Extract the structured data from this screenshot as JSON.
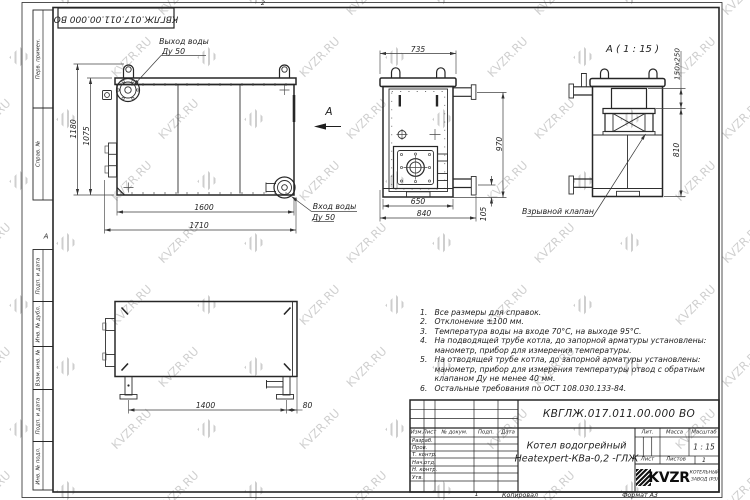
{
  "designations": {
    "main": "КВГЛЖ.017.011.00.000 ВО",
    "top_reversed": "КВГЛЖ.017.011.00.000 ВО"
  },
  "title_block": {
    "product_line1": "Котел водогрейный",
    "product_line2": "Heatexpert-КВа-0,2 -ГЛЖ",
    "cols": {
      "izm": "Изм.",
      "list": "Лист",
      "doc": "№ докум.",
      "podp": "Подп.",
      "data": "Дата"
    },
    "rows": {
      "r1": "Разраб.",
      "r2": "Пров.",
      "r3": "Т. контр.",
      "r4": "Нач.отд.",
      "r5": "Н. контр.",
      "r6": "Утв."
    },
    "lit": "Лит.",
    "massa": "Масса",
    "masshtab": "Масштаб",
    "scale": "1 : 15",
    "list_lbl": "Лист",
    "listov_lbl": "Листов",
    "listov_val": "1",
    "logo": "KVZR",
    "logo_sub1": "КОТЕЛЬНЫЙ",
    "logo_sub2": "ЗАВОД (РЗ)",
    "kopiroval": "Копировал",
    "format": "Формат А3"
  },
  "margins": {
    "perv": "Перв. примен.",
    "sprav": "Справ. №",
    "podp1": "Подп. и дата",
    "inv_dubl": "Инв. № дубл.",
    "vzam": "Взам. инв. №",
    "podp2": "Подп. и дата",
    "inv_podl": "Инв. № подл.",
    "zone_top": "2",
    "zone_left": "А",
    "zone_bottom": "1"
  },
  "callouts": {
    "outlet1": "Выход воды",
    "outlet2": "Ду 50",
    "inlet1": "Вход воды",
    "inlet2": "Ду 50",
    "view_arrow": "А",
    "detail_title": "А ( 1 : 15 )",
    "explosion": "Взрывной клапан"
  },
  "dims": {
    "d1180": "1180",
    "d1075": "1075",
    "d1600": "1600",
    "d1710": "1710",
    "d735": "735",
    "d970": "970",
    "d105": "105",
    "d650": "650",
    "d840": "840",
    "d150x250": "150x250",
    "d810": "810",
    "d1400": "1400",
    "d80": "80"
  },
  "notes": {
    "items": [
      {
        "num": "1.",
        "lines": [
          "Все размеры для справок."
        ]
      },
      {
        "num": "2.",
        "lines": [
          "Отклонение ±100 мм."
        ]
      },
      {
        "num": "3.",
        "lines": [
          "Температура воды на входе 70°С, на выходе 95°С."
        ]
      },
      {
        "num": "4.",
        "lines": [
          "На подводящей трубе котла, до запорной арматуры установлены:",
          "манометр, прибор для измерения температуры."
        ]
      },
      {
        "num": "5.",
        "lines": [
          "На отводящей трубе котла, до запорной арматуры установлены:",
          "манометр, прибор для измерения температуры  отвод с обратным",
          "клапаном Ду не менее 40 мм."
        ]
      },
      {
        "num": "6.",
        "lines": [
          "Остальные требования по ОСТ 108.030.133-84."
        ]
      }
    ]
  },
  "watermark": {
    "text": "KVZR.RU"
  },
  "colors": {
    "line": "#262626",
    "thin": "#454545",
    "watermark": "#c7c7c7"
  }
}
